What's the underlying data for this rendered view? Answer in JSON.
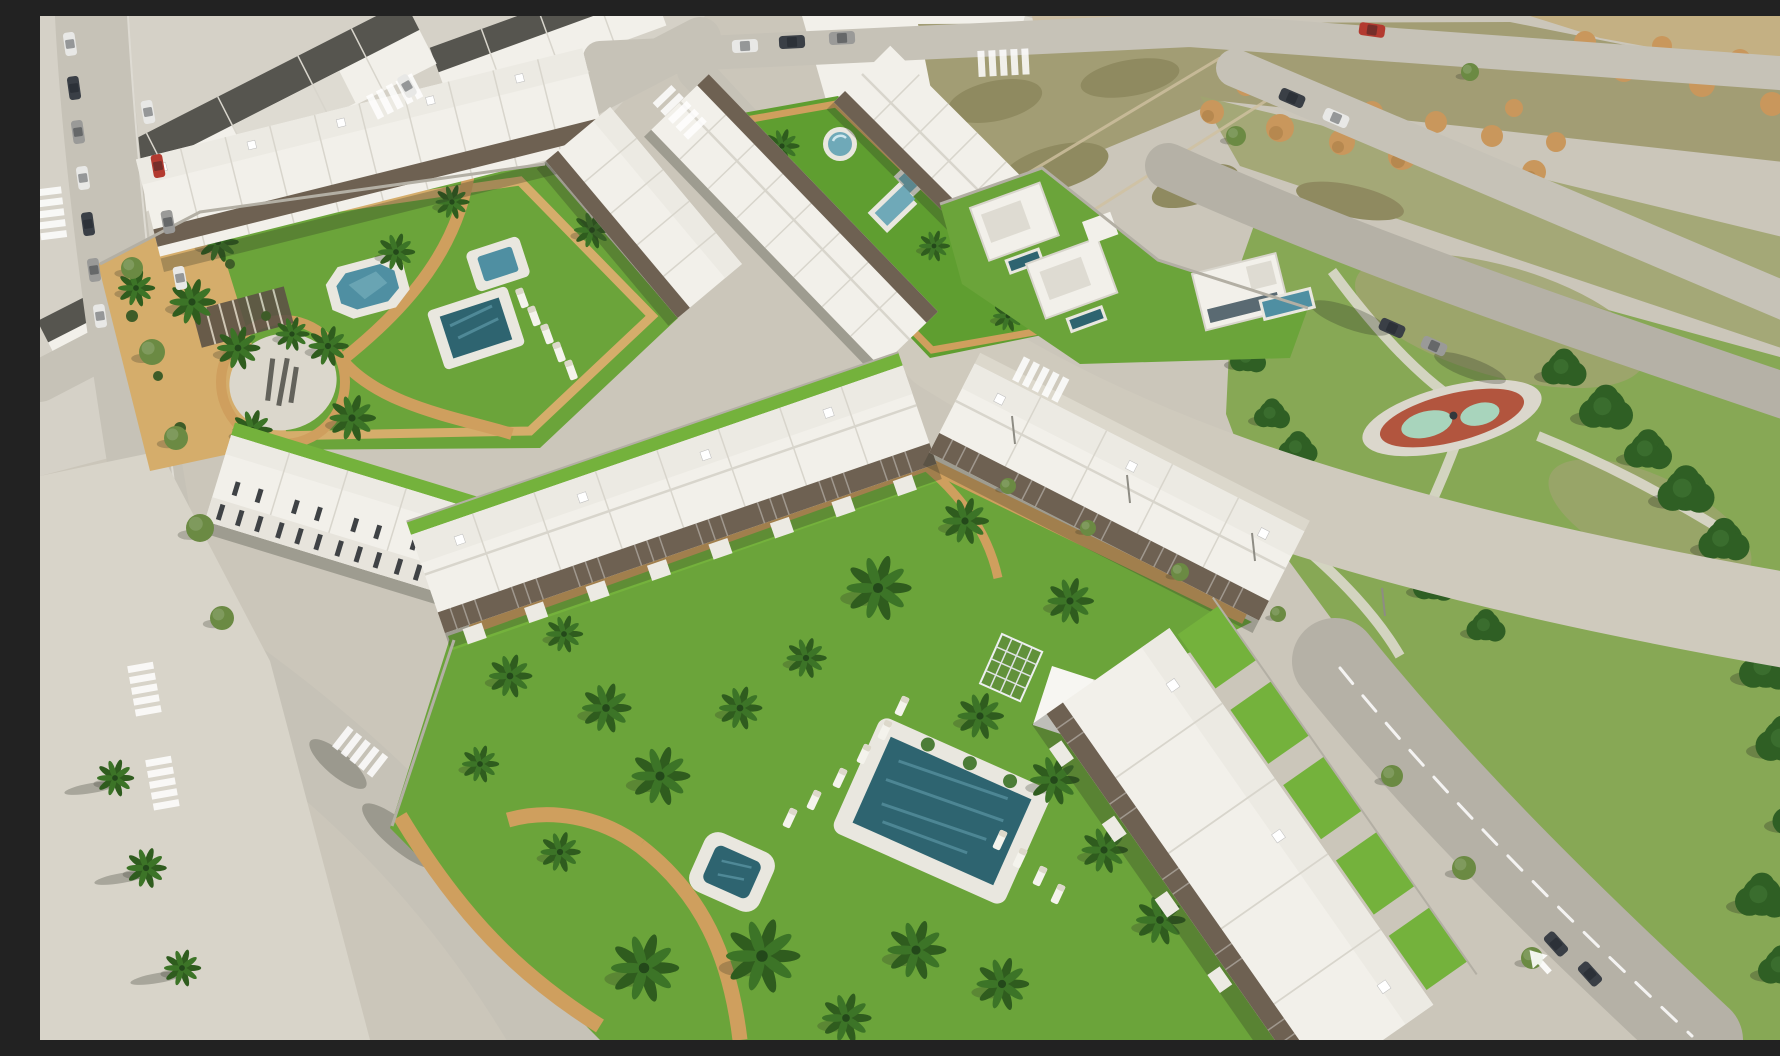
{
  "meta": {
    "title": "Aerial 3D render of a new-build residential development beside an existing town, parks and vacant plots",
    "description": "Oblique aerial architectural visualization: white low-rise apartment rows around landscaped communal gardens with swimming pools, palm trees and sand-coloured paths; existing town blocks top-left, vacant dirt plots with spoil heaps top-right, a pine-tree public park with a playground on the right, and a street grid with crosswalks and parked cars.",
    "visible_text": "none"
  },
  "colors": {
    "ground": "#cbc6ba",
    "townGround": "#d5d1c7",
    "concrete": "#d8d4c9",
    "sidewalk": "#dcd8cc",
    "road": "#c6c2b7",
    "roadDark": "#b5b1a6",
    "roadSand": "#cfcabd",
    "grass": "#6ba43a",
    "grassDeep": "#5f9e30",
    "turf": "#74b23c",
    "grassPark": "#87a855",
    "grassDry": "#a0a470",
    "scrub": "#8f8a60",
    "dirt": "#a29d74",
    "dirtTan": "#c4b083",
    "pile": "#c9975c",
    "pileShade": "#a87c46",
    "pine": "#2f5f24",
    "pineLight": "#3c7030",
    "tree": "#6b8a43",
    "palm": "#3c7427",
    "palmDark": "#2f5c1e",
    "building": "#f2f0ea",
    "buildingShade": "#dedbd2",
    "roofTop": "#eceae3",
    "roofLine": "#d8d5cc",
    "facade": "#e7e4dc",
    "darkWin": "#3f4245",
    "pergola": "#6e6152",
    "wall": "#b3afa4",
    "darkRoof": "#56554f",
    "tanBldg": "#cdbfa4",
    "glass": "#5a6a72",
    "poolDeep": "#2e6470",
    "poolMid": "#4f8fa2",
    "poolLight": "#6fa9b8",
    "poolRim": "#e9e7df",
    "ripple": "#5e98a8",
    "path": "#cf9f5e",
    "pathLight": "#d5ad6b",
    "plaza": "#dbd7cc",
    "mark": "#45453e",
    "playRed": "#b2553e",
    "playMint": "#a8d4bc",
    "white": "#ffffff",
    "carRed": "#b33a30",
    "carDark": "#3a3f46",
    "carGray": "#9a9a98",
    "carWhite": "#e8e8e6",
    "shadow": "rgba(42,46,36,0.28)"
  },
  "scene": {
    "regions": [
      {
        "id": "old-town",
        "label": "existing town blocks with parked cars (top-left)"
      },
      {
        "id": "phase1-complex",
        "label": "apartment rows around garden with ornamental pond, raised spa, pool, palm plaza"
      },
      {
        "id": "linear-garden",
        "label": "linear courtyard with round splash pool, stepped lap pool and plunge pool"
      },
      {
        "id": "villas",
        "label": "detached white villas with private pools"
      },
      {
        "id": "vacant-lots",
        "label": "vacant scrub plots with tan spoil heaps (top-right)"
      },
      {
        "id": "park",
        "label": "public park with pine trees and red playground circle"
      },
      {
        "id": "phase2-complex",
        "label": "apartment rows around large lawn with main pool, spa, loungers, palms"
      },
      {
        "id": "streets",
        "label": "street grid with crosswalks, lane arrow, palm-lined sidewalks"
      }
    ],
    "communal_pools": 8,
    "private_pools": 3
  }
}
